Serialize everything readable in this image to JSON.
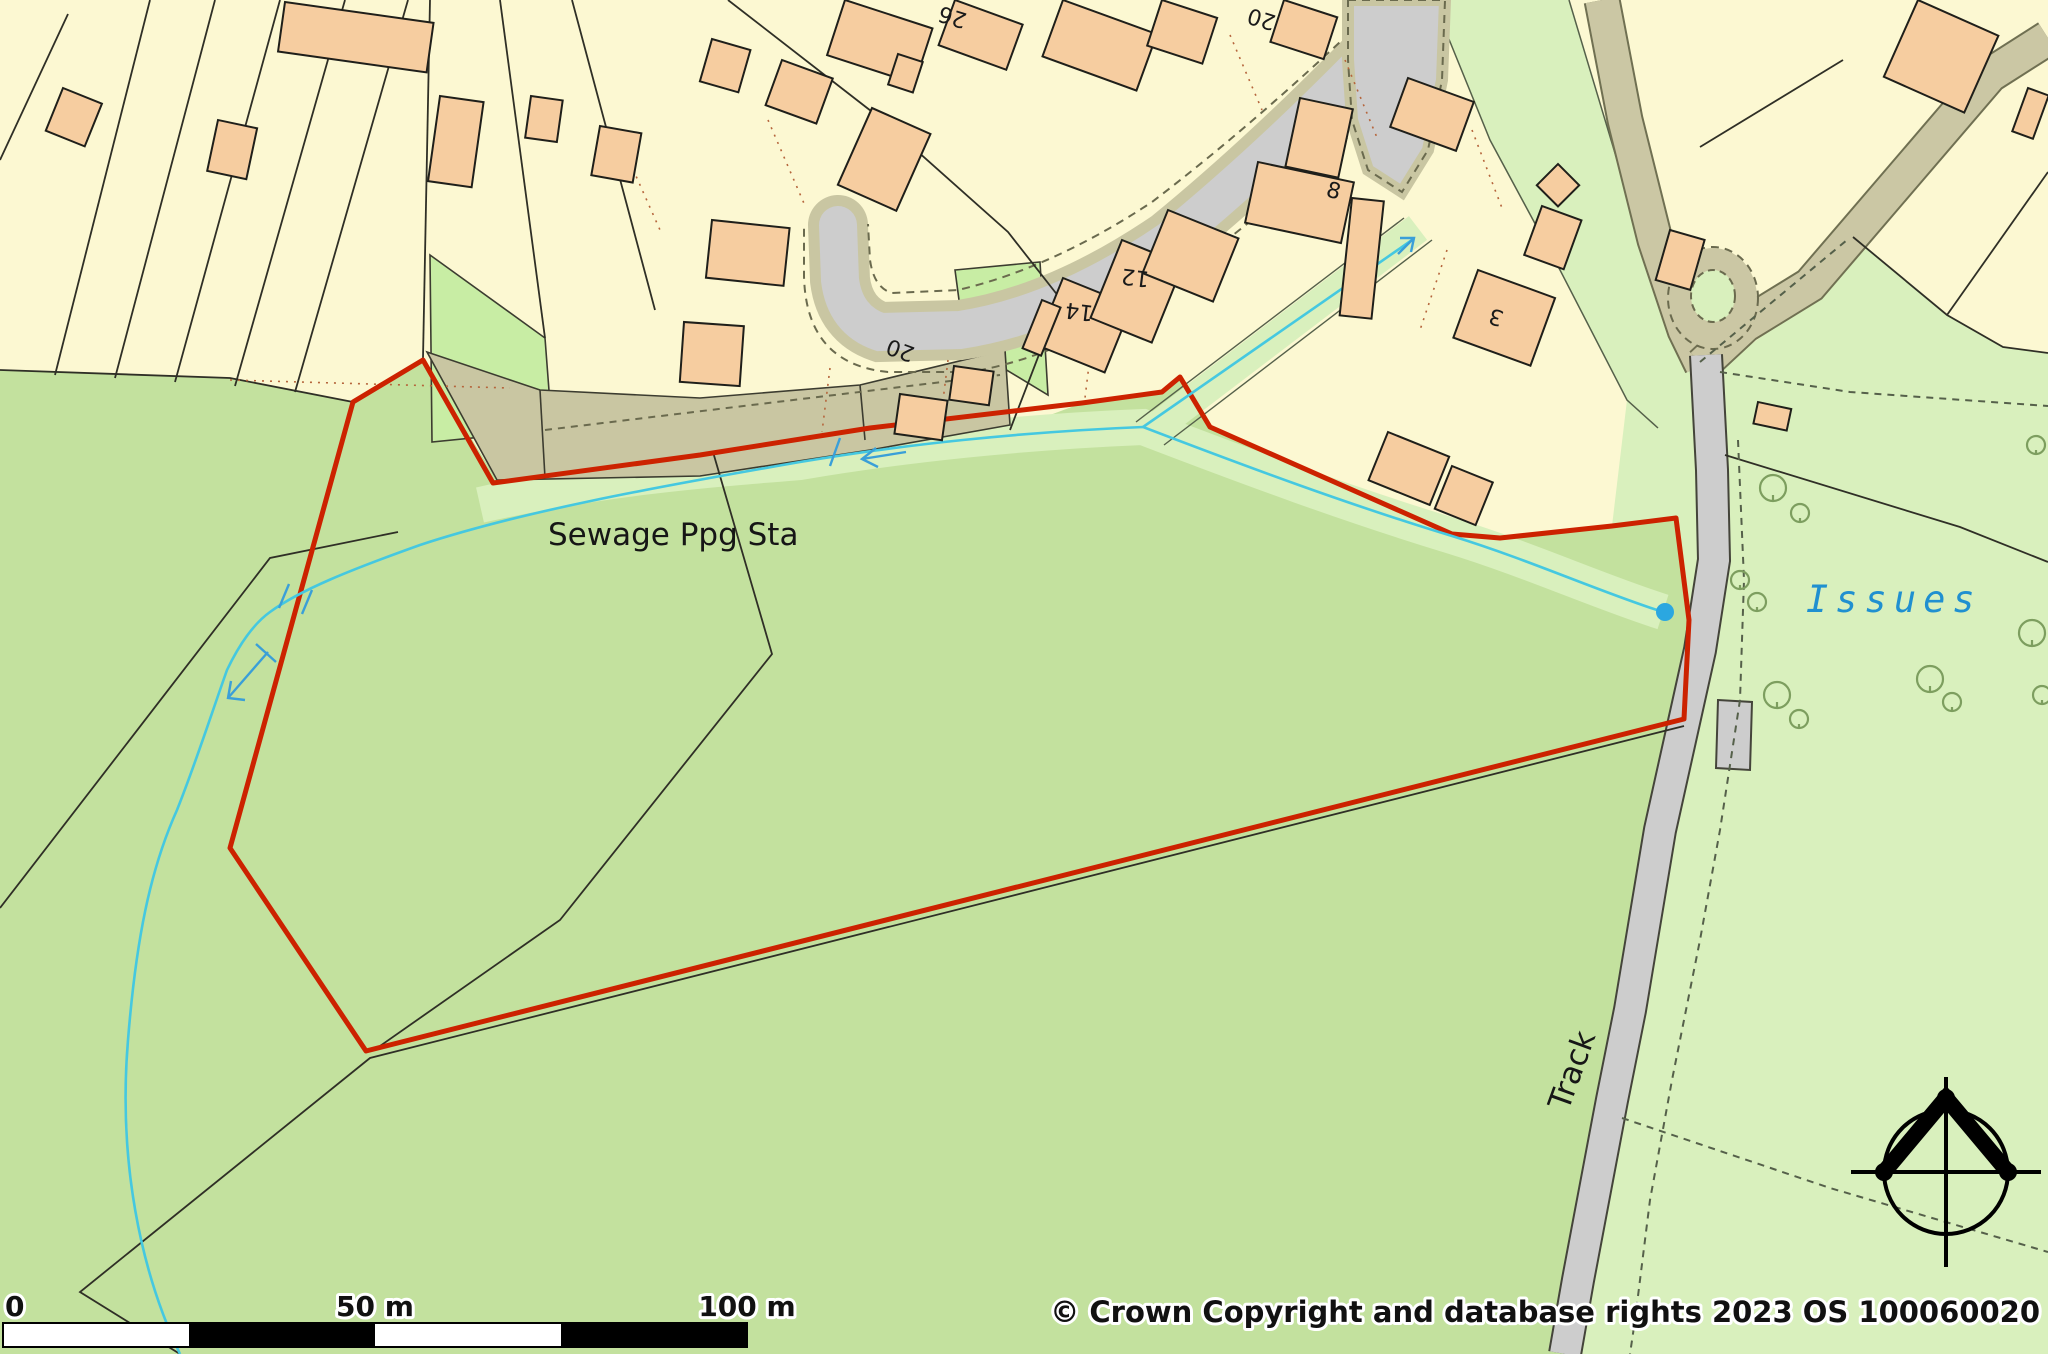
{
  "map": {
    "labels": {
      "sewage": "Sewage Ppg Sta",
      "issues": "Issues",
      "track": "Track"
    },
    "house_numbers": [
      "26",
      "20",
      "20",
      "14",
      "12",
      "8",
      "3"
    ],
    "scale_bar": {
      "zero": "0",
      "fifty": "50 m",
      "hundred": "100 m"
    },
    "copyright": "© Crown Copyright and database rights 2023 OS 100060020",
    "icons": {
      "compass": "north-arrow",
      "tree": "deciduous-tree",
      "flow_arrow": "stream-flow-arrow",
      "spring": "issues-spring-dot"
    },
    "colors": {
      "site_boundary_red": "#cc2200",
      "water_cyan": "#45c8e0",
      "field_green": "#c3e19e",
      "light_green": "#d9f0bd",
      "plot_yellow": "#fcf8d2",
      "building_peach": "#f6cda0",
      "road_gray": "#cdcdcd",
      "verge_olive": "#c9c6a2",
      "label_blue": "#2090d0"
    }
  }
}
